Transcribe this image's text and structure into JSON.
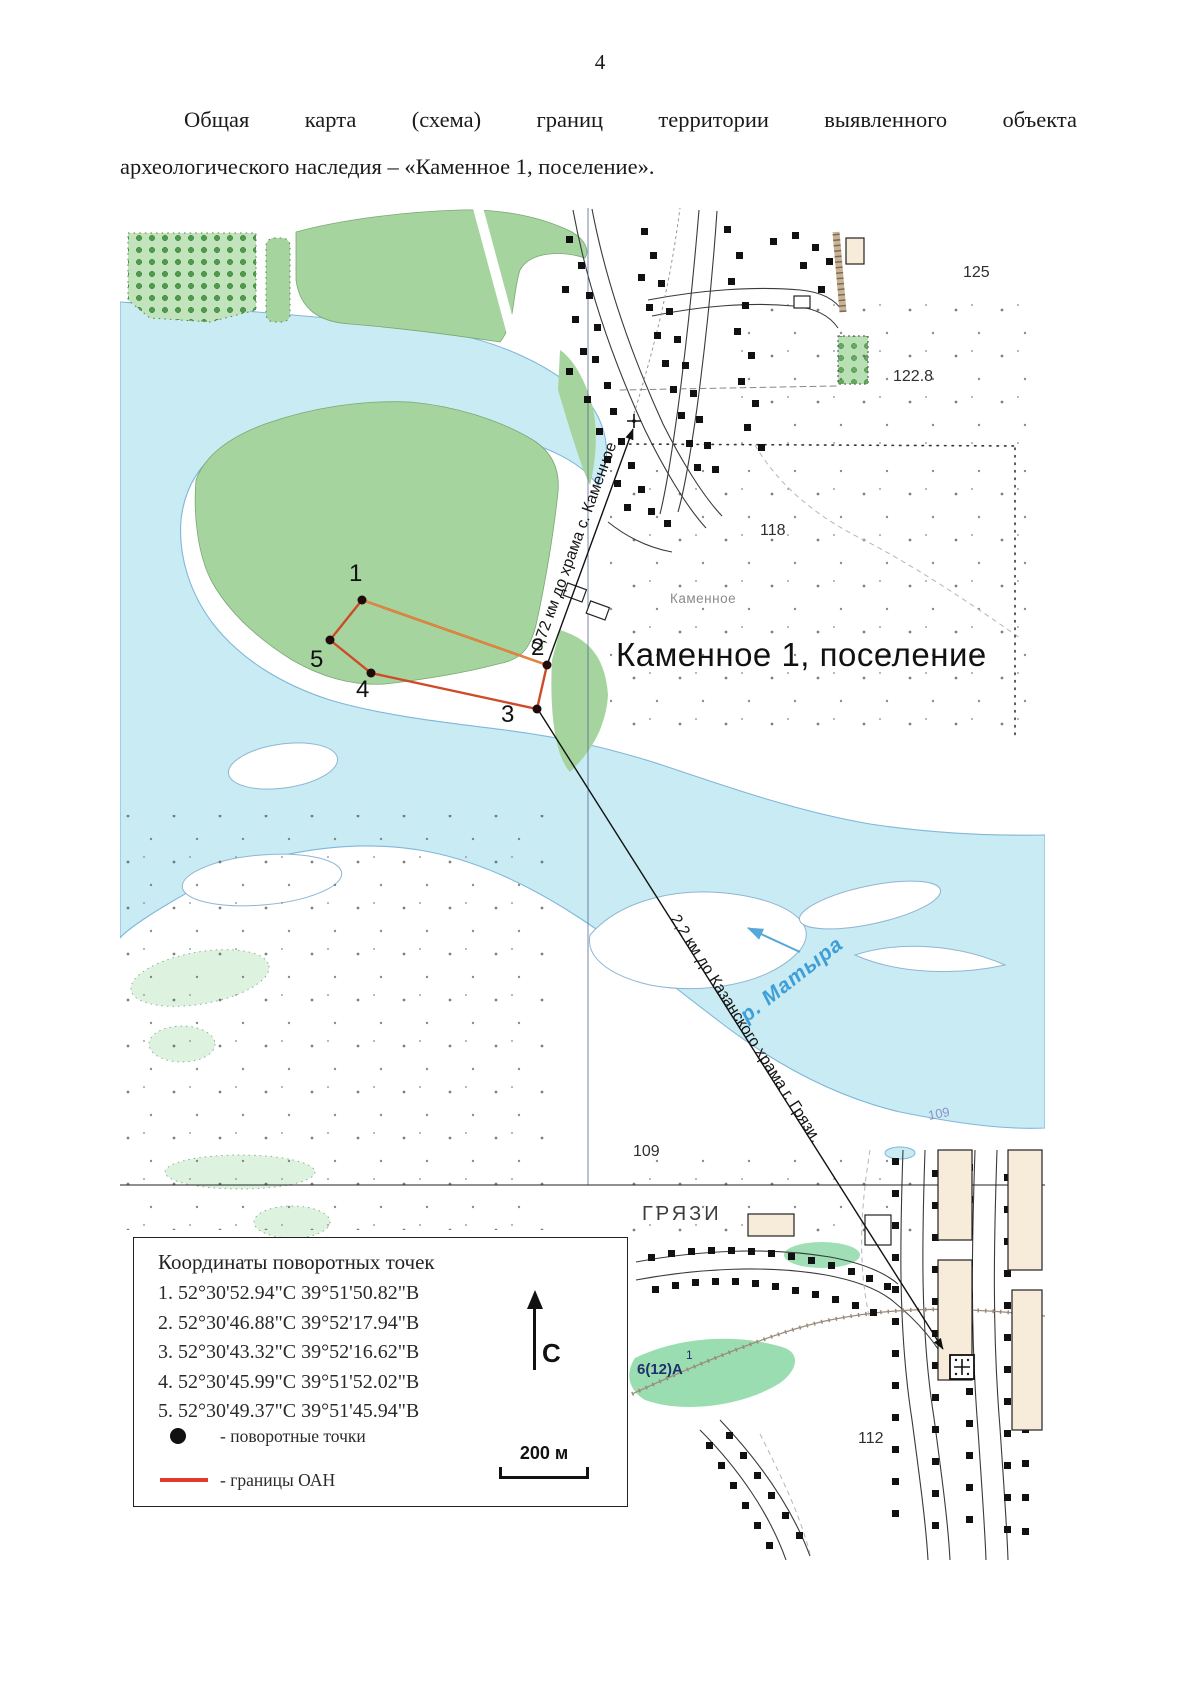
{
  "page": {
    "number": "4",
    "title_line1": "Общая карта (схема) границ территории выявленного объекта",
    "title_line2": "археологического наследия – «Каменное 1, поселение»."
  },
  "map": {
    "site_label": "Каменное 1, поселение",
    "village_label": "Каменное",
    "city_label": "ГРЯЗИ",
    "river_label": "р. Матыра",
    "distance_to_kamennoe": "0,72 км до храма с. Каменное",
    "distance_to_gryazi": "2,2 км до Казанского храма г. Грязи.",
    "elevation_125": "125",
    "elevation_122_8": "122.8",
    "elevation_118": "118",
    "elevation_109": "109",
    "elevation_109_river": "109",
    "elevation_112": "112",
    "plot_label": "6(12)А",
    "plot_index": "1",
    "point_1": "1",
    "point_2": "2",
    "point_3": "3",
    "point_4": "4",
    "point_5": "5"
  },
  "legend": {
    "title": "Координаты поворотных точек",
    "coordinates": [
      "1. 52°30'52.94\"С 39°51'50.82\"В",
      "2. 52°30'46.88\"С 39°52'17.94\"В",
      "3. 52°30'43.32\"С 39°52'16.62\"В",
      "4. 52°30'45.99\"С 39°51'52.02\"В",
      "5. 52°30'49.37\"С 39°51'45.94\"В"
    ],
    "turning_points_label": "- поворотные точки",
    "boundary_label": "- границы ОАН",
    "north_label": "С",
    "scale_label": "200 м"
  },
  "colors": {
    "water": "#c9ebf4",
    "vegetation": "#a6d49f",
    "boundary_red": "#cf4a28",
    "boundary_orange": "#e2873c"
  }
}
